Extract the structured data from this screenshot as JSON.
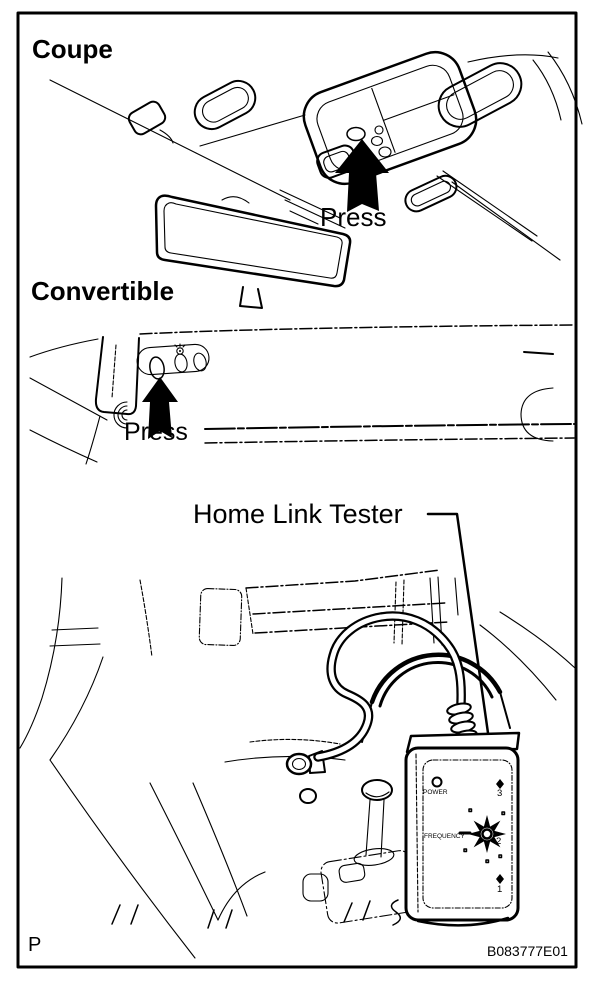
{
  "page": {
    "title": "HomeLink transmitter press locations and tester diagram",
    "colors": {
      "ink": "#000000",
      "paper": "#ffffff"
    },
    "sections": [
      {
        "label": "Coupe",
        "press_label": "Press"
      },
      {
        "label": "Convertible",
        "press_label": "Press"
      }
    ],
    "tester": {
      "callout": "Home Link Tester",
      "power_label": "POWER",
      "frequency_label": "FREQUENCY",
      "channel_labels": [
        "3",
        "2",
        "1"
      ]
    },
    "footer": {
      "page_marker": "P",
      "figure_id": "B083777E01"
    }
  }
}
